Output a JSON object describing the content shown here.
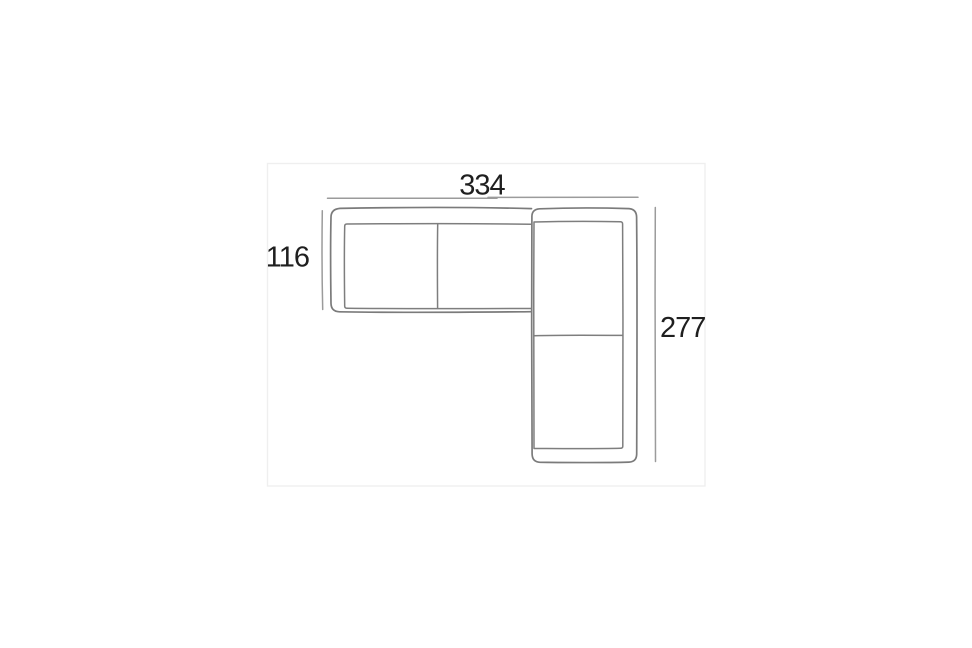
{
  "diagram": {
    "type": "sofa-top-view-dimension-schematic",
    "description": "L-shaped corner sofa floor plan with three dimension lines",
    "labels": {
      "width_top": "334",
      "depth_left": "116",
      "height_right": "277"
    },
    "sections": {
      "left_section_cushions": 2,
      "corner_section_cushions": 2
    },
    "colors": {
      "background": "#ffffff",
      "outline": "#7b7b7b",
      "dimension_line": "#9b9b9b",
      "label_text": "#1f1f1f",
      "frame": "#efefef"
    }
  }
}
